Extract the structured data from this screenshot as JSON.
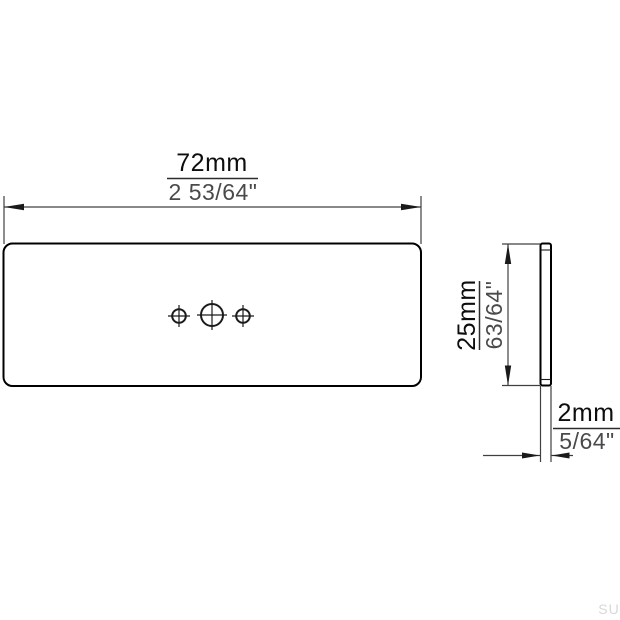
{
  "drawing": {
    "type": "technical-drawing",
    "views": {
      "front": "plate-front-view",
      "side": "plate-side-profile"
    },
    "dimensions": {
      "width": {
        "metric": "72mm",
        "imperial": "2 53/64\""
      },
      "height": {
        "metric": "25mm",
        "imperial": "63/64\""
      },
      "thickness": {
        "metric": "2mm",
        "imperial": "5/64\""
      }
    },
    "colors": {
      "outline": "#000000",
      "dimension_line": "#404040",
      "metric_text": "#0d0d0d",
      "imperial_text": "#4a4a4a",
      "watermark": "#d8d8d8",
      "background": "#ffffff"
    }
  },
  "watermark": {
    "text": "SU"
  }
}
